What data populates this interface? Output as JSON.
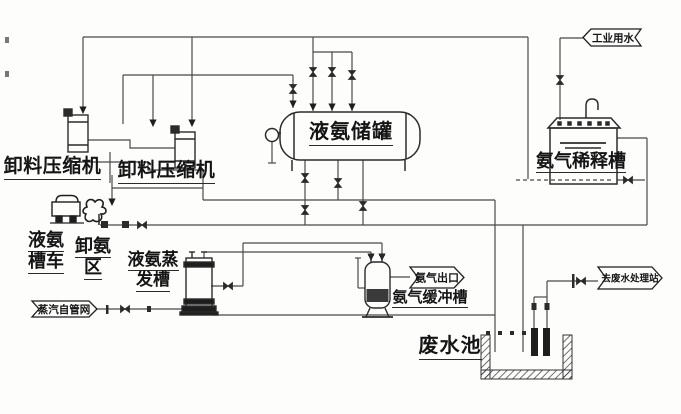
{
  "diagram": {
    "colors": {
      "background": "#fdfdfc",
      "line": "#4a4a4a",
      "equipment": "#2b2b2b",
      "text": "#151515"
    },
    "labels": {
      "compressor_left": "卸料压缩机",
      "compressor_right": "卸料压缩机",
      "storage_tank": "液氨储罐",
      "dilution_tank": "氨气稀释槽",
      "tanker_line1": "液氨",
      "tanker_line2": "槽车",
      "unload_area_line1": "卸氨",
      "unload_area_line2": "区",
      "evaporator_line1": "液氨蒸",
      "evaporator_line2": "发槽",
      "buffer_tank": "氨气缓冲槽",
      "wastewater_pool": "废水池"
    },
    "stream_tags": {
      "industrial_water": "工业用水",
      "steam_from_network": "蒸汽自管网",
      "ammonia_outlet": "氨气出口",
      "to_wastewater_plant": "去废水处理站"
    }
  }
}
